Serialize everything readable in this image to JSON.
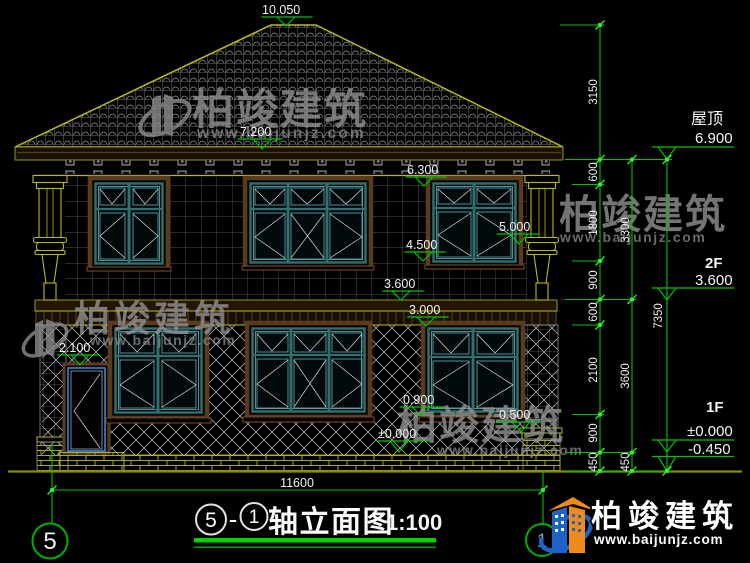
{
  "levels": {
    "ridge": "10.050",
    "eave": "7.200",
    "window2f_top": "6.300",
    "column_band": "5.000",
    "window2f_sill": "4.500",
    "floor_2f": "3.600",
    "window1f_top": "3.000",
    "door_top": "2.100",
    "window1f_sill": "0.900",
    "pier_cap": "0.500",
    "ground_floor": "±0.000"
  },
  "right_panel": {
    "roof_label": "屋顶",
    "roof_value": "6.900",
    "f2_label": "2F",
    "f2_value": "3.600",
    "f1_label": "1F",
    "f1_value": "±0.000",
    "below_ground": "-0.450"
  },
  "dimensions": {
    "chain_inner": [
      "3150",
      "600",
      "1800",
      "900",
      "600",
      "2100",
      "900",
      "450"
    ],
    "chain_mid": [
      "3300",
      "3600",
      "450"
    ],
    "chain_outer": "7350",
    "overall_width": "11600"
  },
  "axes": {
    "left": "5",
    "right": "1"
  },
  "title_block": {
    "axis_start": "5",
    "separator": "-",
    "axis_end": "1",
    "name": "轴立面图",
    "scale": "1:100"
  },
  "watermark": {
    "brand": "柏竣建筑",
    "url": "www.baijunjz.com"
  },
  "brand_logo": {
    "name": "柏竣建筑",
    "url": "www.baijunjz.com"
  }
}
